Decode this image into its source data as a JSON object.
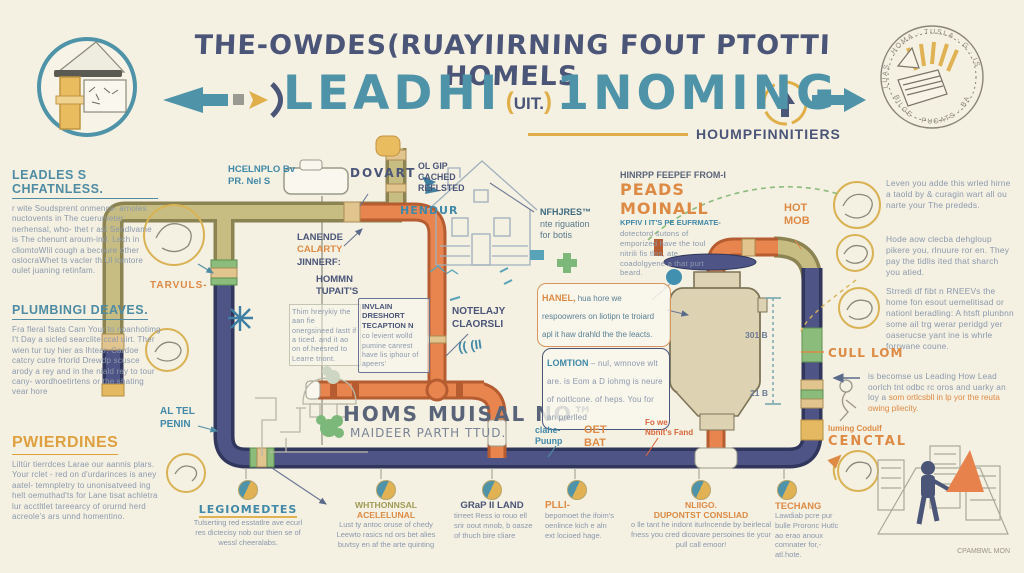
{
  "palette": {
    "background": "#f4f0e2",
    "ink_navy": "#4a5578",
    "accent_teal": "#4e93a8",
    "accent_orange": "#dd8a44",
    "pipe_orange": "#e8854f",
    "pipe_olive": "#c7bd82",
    "pipe_navy": "#4e5486",
    "pipe_green": "#8cbc7c",
    "gold": "#e0b254"
  },
  "header": {
    "title_line1": "THE-OWDES(RUAYIIRNING FOUT PTOTTI HOMELS",
    "lead": "LEADHI",
    "mid_open": "(",
    "mid": "UIT.",
    "mid_close": ")",
    "incoming": "1NOMING",
    "subtitle": "HOUMPFINNITIERS"
  },
  "seal": {
    "arc_top": "LUAS · HOMA · TUSLA · G · IS",
    "arc_bottom": "BILGE · PUGATS · BAI"
  },
  "left_column": {
    "sections": [
      {
        "heading": "LEADLES S CHFATNLESS.",
        "body": "r wite Soudsprent onmencs- arnoles nuctovents in The cuerurveter nerhensal, who- thet r ast Sendlvame is The chenunt aroum-ind. Lech in cllomtoWlil cough a becoure other oslocraWhet ts vacler th Ul lomtore oulet juaning retinfam."
      },
      {
        "heading": "PLUMBINGI DEAVES.",
        "body": "Fra fleral fsats Cam Your to noanhotimg I't Day a sicled searclite ccal uirt. Ther wien tur tuy hier as lhtear. Cardoe catcry cutre frtorld Drewdp scusce arody a rey and in the niald rey to tour cany- wordhoetirtens or the shating vear hore"
      },
      {
        "heading": "PWIERDINES",
        "body": "Liltür tierrdces Larae our aannis plars. Your rclet - red on d'urdarinces is aney aatel- temnpletry to unonisatveed ing helt oemuthad'ts for Lane tisat achletra lur acctltlet tareearcy of orurnd herd acreole's ars unnd homentino."
      }
    ]
  },
  "right_column": {
    "paragraphs": [
      "Leven you adde this wrled hirne a taold by & curagin wart all ou narte your The prededs.",
      "Hode aow clecba dehgloup pikere you, rlnuure ror en. They pay the tidlis ited that sharch you atied.",
      "Strredi df fibt n RNEEVs the home fon esout uemelitisad or nationl beradling: A htsft plunbnn some ail trg werar peridgd yer oaserucse yant ine is whrle forrwane coune."
    ],
    "cull_lom": "CULL LOM",
    "lead_note_start": "is becomse us Leading How Lead oorlch tnt odbc rc oros and uarky an loy a ",
    "lead_note_highlight": "som ortlcsbll in lp yor the reuta owing pliecity.",
    "cenctal_small": "luming Codulf",
    "cenctal": "CENCTAL",
    "credit": "CPAMBWL MON"
  },
  "diagram": {
    "hcelnplo": "HCELNPLO Bv",
    "hcelnplo2": "PR. Nel S",
    "dovart": "DOVART",
    "hendur": "HENDUR",
    "lanende": "LANENDE",
    "calarty": "CALARTY",
    "jinnerf": "JINNERF:",
    "hommn": "HOMMN",
    "tupaits": "TUPAIT'S",
    "tarvuls": "TARVULS-",
    "al_tel": "AL TEL",
    "penin": "PENIN",
    "thim_note": "Thim hrerykiy the aan fie onergsineed lastt if a ticed. and it ao on of.heesred to Learre tnont.",
    "invlain_title": "INVLAIN DRESHORT TECAPTION N",
    "invlain_body": "co levient wolld pumine canrest have lis iphour of apeers'",
    "notelajy": "NOTELAJY",
    "claorsli": "CLAORSLI",
    "quote": "(( (II",
    "homs": "HOMS MUISAL NO™",
    "maideer": "MAIDEER PARTH TTUD.",
    "ol_gip": "OL GIP",
    "cached": "CACHED",
    "reflsted": "REFLSTED",
    "nfhjres": "NFHJRES™",
    "nfhjres2": "nte riguation",
    "nfhjres3": "for botis",
    "hinrpp": "HINRPP FEEPEF FROM-I",
    "peads": "PEADS MOINALL",
    "kpfiv": "KPFIV I IT'S PE EUFRMATE-",
    "peads_body": "dotectord sutons of emporized have the toul nitrili fis tlos, ate coadolgyene a that purt beard.",
    "hanel": "HANEL,",
    "hanel_body": " hua hore we respoowrers on liotipn te troiard apl it haw drahld the the leacts.",
    "lomtion": "LOMTION",
    "lomtion_body": " – nul, wmnove wlt are. is Eom a D iohmg is neure of noitlcone. of heps. You for an prerlled",
    "hot": "HOT",
    "mob": "MOB",
    "dim_top": "301  B",
    "dim_bottom": "21  B",
    "clahe": "clahe-",
    "puunp": "Puunp",
    "oet": "OET",
    "bat": "BAT",
    "fo_we": "Fo we",
    "fand": "Nbnlt's Fand"
  },
  "legend": {
    "items": [
      {
        "heading": "LEGIOMEDTES",
        "heading2": "",
        "body": "Tulserting red esstatlre ave ecurl res dictecisy nob our thien se of wessl cheeralabs."
      },
      {
        "heading": "WHTHONNSAL",
        "heading2": "ACELELUNAL",
        "body": "Lust ty antoc oruse of chedy Leewto rasics nd ors bet alies buvtsy en af the arte quinting"
      },
      {
        "heading": "GRaP II LAND",
        "heading2": "",
        "body": "tirreet Ress io rouo ell srir oout mnob, b oasze of thuch bire cliare"
      },
      {
        "heading": "PLLI-",
        "heading2": "",
        "body": "bepomoet the ifoim's oenlince kich e aln ext locioed hage."
      },
      {
        "heading": "NLIIGO.",
        "heading2": "DUPONTST CONSLIAD",
        "body": "o lle tant he indont iturlncende by beirlecal fness you cred dicovare persoines tie ycur pull call emoor!"
      },
      {
        "heading": "TECHANG",
        "heading2": "",
        "body": "Lawdiab pcre pur bulle Proronc Hutlc ao erao anoux comnater for,-atl.hote."
      }
    ]
  }
}
